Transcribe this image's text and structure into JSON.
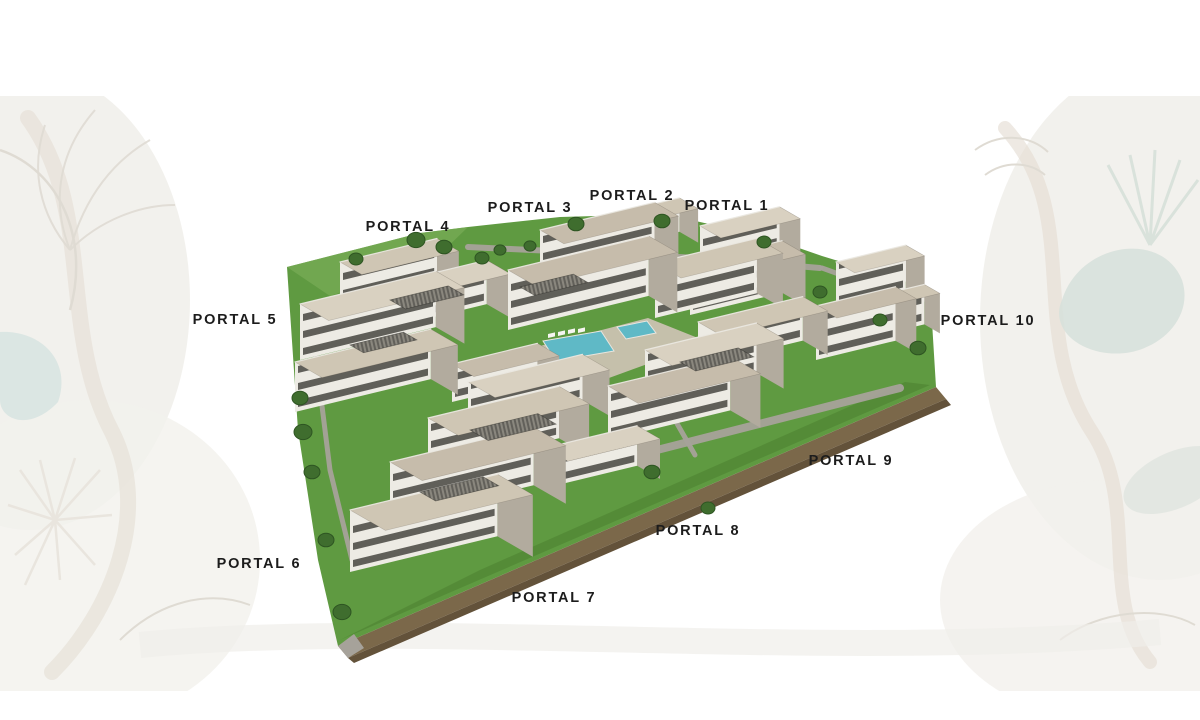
{
  "title": "Residential development aerial rendering with portal labels",
  "labels": [
    {
      "id": 1,
      "text": "PORTAL 1",
      "x": 727,
      "y": 206
    },
    {
      "id": 2,
      "text": "PORTAL 2",
      "x": 632,
      "y": 196
    },
    {
      "id": 3,
      "text": "PORTAL 3",
      "x": 530,
      "y": 208
    },
    {
      "id": 4,
      "text": "PORTAL 4",
      "x": 408,
      "y": 227
    },
    {
      "id": 5,
      "text": "PORTAL 5",
      "x": 235,
      "y": 320
    },
    {
      "id": 6,
      "text": "PORTAL 6",
      "x": 259,
      "y": 564
    },
    {
      "id": 7,
      "text": "PORTAL 7",
      "x": 554,
      "y": 598
    },
    {
      "id": 8,
      "text": "PORTAL 8",
      "x": 698,
      "y": 531
    },
    {
      "id": 9,
      "text": "PORTAL 9",
      "x": 851,
      "y": 461
    },
    {
      "id": 10,
      "text": "PORTAL 10",
      "x": 988,
      "y": 321
    }
  ],
  "palette": {
    "label": "#1c1c1c",
    "grass": "#5f9a41",
    "grassDark": "#46792c",
    "grassLight": "#79ac57",
    "roofA": "#cfc6b4",
    "roofB": "#d9d1c1",
    "roofC": "#c6bcab",
    "wall": "#edebe4",
    "wallShade": "#b2ab9e",
    "window": "#413f3a",
    "path": "#a6a29a",
    "plaza": "#cac2b1",
    "dirt": "#7b684a",
    "dirtDark": "#63523a",
    "pool": "#5fb9c6",
    "lounger": "#f6f5f1",
    "tree": "#3f6d2e",
    "treeDark": "#2e5522",
    "decorBlob": "#f0eee9",
    "decorBranch": "#ded6c9",
    "decorLine": "#d8d3c9",
    "decorSage": "#cdd9d2",
    "decorTeal": "#cfdfdb"
  },
  "scene": {
    "site_polygon": [
      [
        287,
        267
      ],
      [
        420,
        233
      ],
      [
        468,
        227
      ],
      [
        560,
        217
      ],
      [
        665,
        214
      ],
      [
        770,
        238
      ],
      [
        822,
        256
      ],
      [
        930,
        289
      ],
      [
        936,
        387
      ],
      [
        338,
        646
      ],
      [
        318,
        560
      ],
      [
        298,
        430
      ]
    ],
    "grass_patches": [
      {
        "points": [
          [
            287,
            267
          ],
          [
            420,
            233
          ],
          [
            468,
            227
          ],
          [
            432,
            262
          ],
          [
            330,
            296
          ]
        ],
        "fill": "grassLight",
        "opacity": 0.7
      },
      {
        "points": [
          [
            340,
            640
          ],
          [
            930,
            385
          ],
          [
            905,
            382
          ],
          [
            480,
            570
          ]
        ],
        "fill": "grassDark",
        "opacity": 0.45
      }
    ],
    "walk_paths": [
      {
        "points": [
          [
            468,
            247
          ],
          [
            700,
            258
          ],
          [
            820,
            268
          ]
        ],
        "width": 6
      },
      {
        "points": [
          [
            822,
            268
          ],
          [
            905,
            298
          ]
        ],
        "width": 5
      },
      {
        "points": [
          [
            618,
            460
          ],
          [
            900,
            388
          ]
        ],
        "width": 8
      },
      {
        "points": [
          [
            655,
            385
          ],
          [
            695,
            455
          ]
        ],
        "width": 5
      },
      {
        "points": [
          [
            310,
            310
          ],
          [
            330,
            470
          ],
          [
            352,
            560
          ]
        ],
        "width": 5
      }
    ],
    "plaza_polygon": [
      [
        505,
        355
      ],
      [
        648,
        318
      ],
      [
        708,
        342
      ],
      [
        565,
        394
      ]
    ],
    "pools": [
      [
        [
          543,
          341
        ],
        [
          601,
          331
        ],
        [
          614,
          351
        ],
        [
          556,
          361
        ]
      ],
      [
        [
          617,
          327
        ],
        [
          647,
          321
        ],
        [
          656,
          333
        ],
        [
          626,
          339
        ]
      ]
    ],
    "loungers": [
      [
        548,
        334
      ],
      [
        558,
        332
      ],
      [
        568,
        330
      ],
      [
        578,
        329
      ]
    ],
    "dirt_bands": [
      {
        "points": [
          [
            936,
            387
          ],
          [
            946,
            399
          ],
          [
            348,
            658
          ],
          [
            338,
            646
          ]
        ],
        "fill": "dirt"
      },
      {
        "points": [
          [
            946,
            399
          ],
          [
            951,
            405
          ],
          [
            354,
            663
          ],
          [
            348,
            658
          ]
        ],
        "fill": "dirtDark"
      },
      {
        "points": [
          [
            338,
            646
          ],
          [
            348,
            658
          ],
          [
            364,
            648
          ],
          [
            354,
            634
          ]
        ],
        "fill": "path"
      }
    ],
    "buildings": [
      {
        "x": 340,
        "y": 302,
        "w": 100,
        "d": 42,
        "h": 40
      },
      {
        "x": 380,
        "y": 330,
        "w": 110,
        "d": 46,
        "h": 44
      },
      {
        "x": 300,
        "y": 360,
        "w": 140,
        "d": 55,
        "h": 56
      },
      {
        "x": 295,
        "y": 412,
        "w": 140,
        "d": 52,
        "h": 50
      },
      {
        "x": 596,
        "y": 252,
        "w": 86,
        "d": 36,
        "h": 34
      },
      {
        "x": 540,
        "y": 282,
        "w": 118,
        "d": 46,
        "h": 52
      },
      {
        "x": 508,
        "y": 330,
        "w": 145,
        "d": 55,
        "h": 60
      },
      {
        "x": 655,
        "y": 318,
        "w": 105,
        "d": 50,
        "h": 55
      },
      {
        "x": 700,
        "y": 268,
        "w": 82,
        "d": 40,
        "h": 42
      },
      {
        "x": 690,
        "y": 315,
        "w": 95,
        "d": 45,
        "h": 52
      },
      {
        "x": 836,
        "y": 308,
        "w": 72,
        "d": 36,
        "h": 46
      },
      {
        "x": 868,
        "y": 338,
        "w": 58,
        "d": 30,
        "h": 40
      },
      {
        "x": 816,
        "y": 360,
        "w": 82,
        "d": 40,
        "h": 54
      },
      {
        "x": 698,
        "y": 366,
        "w": 108,
        "d": 48,
        "h": 44
      },
      {
        "x": 645,
        "y": 400,
        "w": 115,
        "d": 52,
        "h": 50
      },
      {
        "x": 608,
        "y": 440,
        "w": 126,
        "d": 58,
        "h": 54
      },
      {
        "x": 452,
        "y": 402,
        "w": 88,
        "d": 42,
        "h": 38
      },
      {
        "x": 468,
        "y": 428,
        "w": 118,
        "d": 52,
        "h": 46
      },
      {
        "x": 428,
        "y": 470,
        "w": 135,
        "d": 58,
        "h": 52
      },
      {
        "x": 390,
        "y": 520,
        "w": 148,
        "d": 62,
        "h": 58
      },
      {
        "x": 545,
        "y": 488,
        "w": 95,
        "d": 44,
        "h": 40
      },
      {
        "x": 350,
        "y": 572,
        "w": 152,
        "d": 68,
        "h": 62
      }
    ],
    "louver_roofs": [
      {
        "x": 390,
        "y": 300,
        "w": 60,
        "d": 30
      },
      {
        "x": 350,
        "y": 345,
        "w": 55,
        "d": 26
      },
      {
        "x": 520,
        "y": 287,
        "w": 55,
        "d": 28
      },
      {
        "x": 680,
        "y": 362,
        "w": 60,
        "d": 30
      },
      {
        "x": 470,
        "y": 430,
        "w": 70,
        "d": 35
      },
      {
        "x": 420,
        "y": 492,
        "w": 65,
        "d": 30
      }
    ],
    "trees": [
      [
        416,
        240,
        9
      ],
      [
        444,
        247,
        8
      ],
      [
        482,
        258,
        7
      ],
      [
        356,
        259,
        7
      ],
      [
        500,
        250,
        6
      ],
      [
        530,
        246,
        6
      ],
      [
        576,
        224,
        8
      ],
      [
        662,
        221,
        8
      ],
      [
        764,
        242,
        7
      ],
      [
        820,
        292,
        7
      ],
      [
        880,
        320,
        7
      ],
      [
        918,
        348,
        8
      ],
      [
        300,
        398,
        8
      ],
      [
        303,
        432,
        9
      ],
      [
        312,
        472,
        8
      ],
      [
        326,
        540,
        8
      ],
      [
        342,
        612,
        9
      ],
      [
        652,
        472,
        8
      ],
      [
        708,
        508,
        7
      ]
    ]
  }
}
